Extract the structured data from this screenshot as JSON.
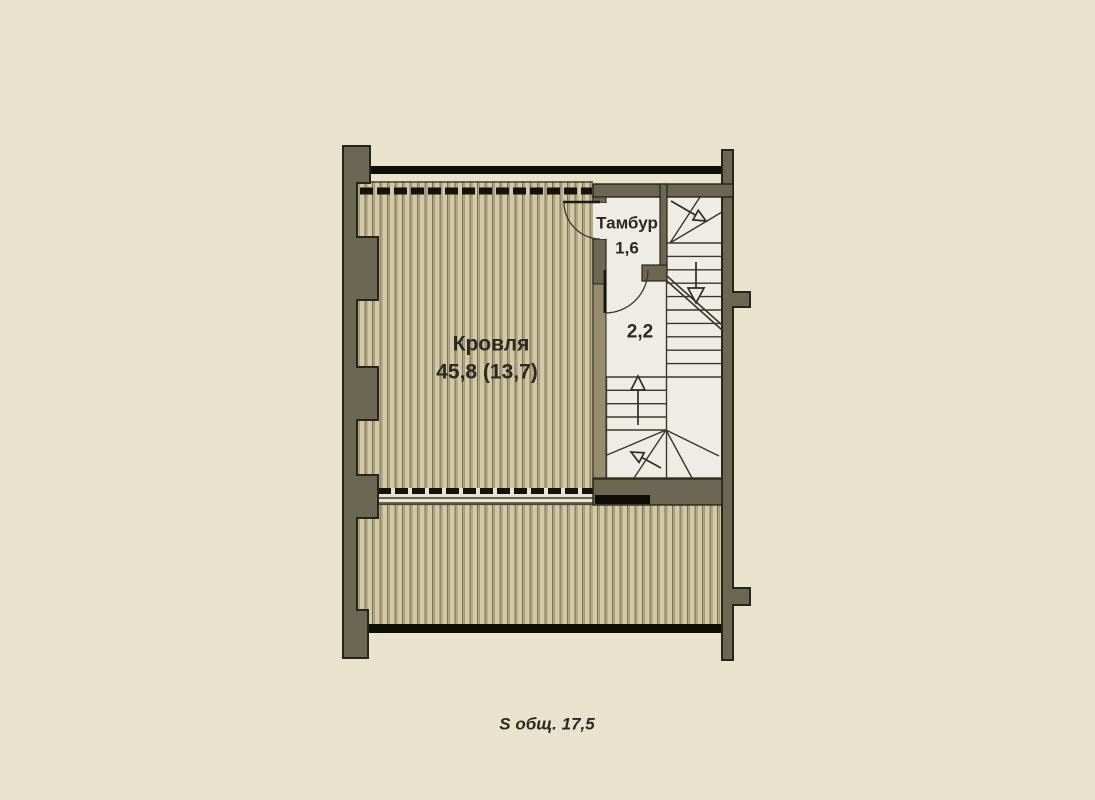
{
  "plan": {
    "title": "Floor plan — roof level",
    "rooms": {
      "roof": {
        "name": "Кровля",
        "area": "45,8 (13,7)"
      },
      "tambour": {
        "name": "Тамбур",
        "area": "1,6"
      },
      "stair_landing": {
        "area": "2,2"
      }
    },
    "caption": "S общ. 17,5"
  },
  "colors": {
    "background": "#e9e3cd",
    "wall": "#6b6752",
    "wall_light": "#968d6f",
    "wall_outline": "#26251b",
    "roof_hatch_light": "#d3c9a5",
    "roof_hatch_mid": "#b0a682",
    "roof_hatch_dark_line": "#6f6850",
    "floor": "#efece6",
    "drawing_line": "#3a382f",
    "black_band": "#0e0d08",
    "label_text": "#2b2922"
  }
}
